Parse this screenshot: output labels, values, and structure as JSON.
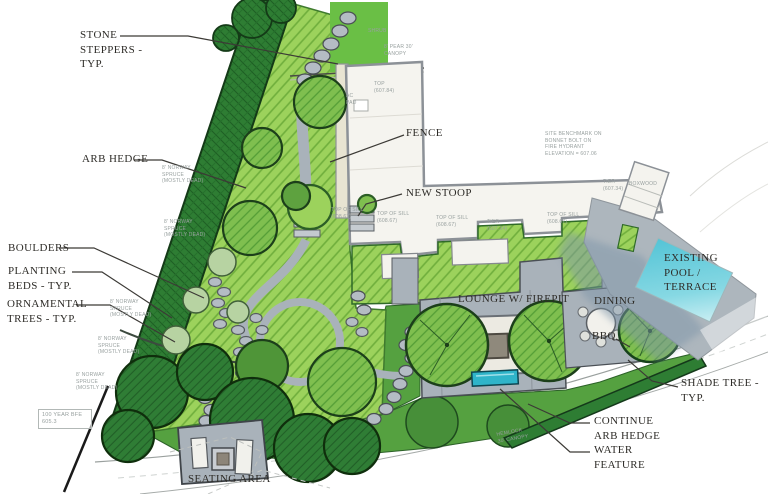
{
  "plan": {
    "labels": {
      "stone_steppers": "STONE STEPPERS - TYP.",
      "arb_hedge": "ARB HEDGE",
      "boulders": "BOULDERS",
      "planting_beds": "PLANTING BEDS - TYP.",
      "ornamental_trees": "ORNAMENTAL TREES - TYP.",
      "fence": "FENCE",
      "new_stoop": "NEW STOOP",
      "lounge": "LOUNGE W/ FIREPIT",
      "dining": "DINING",
      "bbq": "BBQ",
      "existing_pool": "EXISTING POOL / TERRACE",
      "shade_tree": "SHADE TREE - TYP.",
      "continue_arb_hedge": "CONTINUE ARB HEDGE",
      "water_feature": "WATER FEATURE",
      "seating_area": "SEATING AREA"
    },
    "survey_notes": {
      "bfe": "100 YEAR BFE 605.3",
      "benchmark": "SITE BENCHMARK ON BONNET BOLT ON FIRE HYDRANT ELEVATION = 607.06",
      "norway_spruce": "8' NORWAY SPRUCE (MOSTLY DEAD)",
      "pear": "8' PEAR 30' CANOPY",
      "shrub": "SHRUB",
      "hemlock": "HEMLOCK 30' CANOPY",
      "top_of_sill": "TOP OF SILL (608.67)",
      "tier": "TIER (607.34)",
      "top": "TOP (607.84)",
      "boxwood": "BOXWOOD",
      "ac_pad": "AC PAD"
    },
    "colors": {
      "planting_bed_green": "#9cd25c",
      "bed_hatch_green": "#6fae3c",
      "hedge_dark_green": "#2e7d33",
      "lawn_green": "#55a140",
      "tree_green": "#7fbf4f",
      "dark_tree_green": "#2f7d35",
      "paving_grey": "#a9b2ba",
      "pool_cyan": "#5ec9da",
      "water_feature_cyan": "#2fb4c9",
      "label_ink": "#2e2c28",
      "note_grey": "#98a09f"
    }
  }
}
